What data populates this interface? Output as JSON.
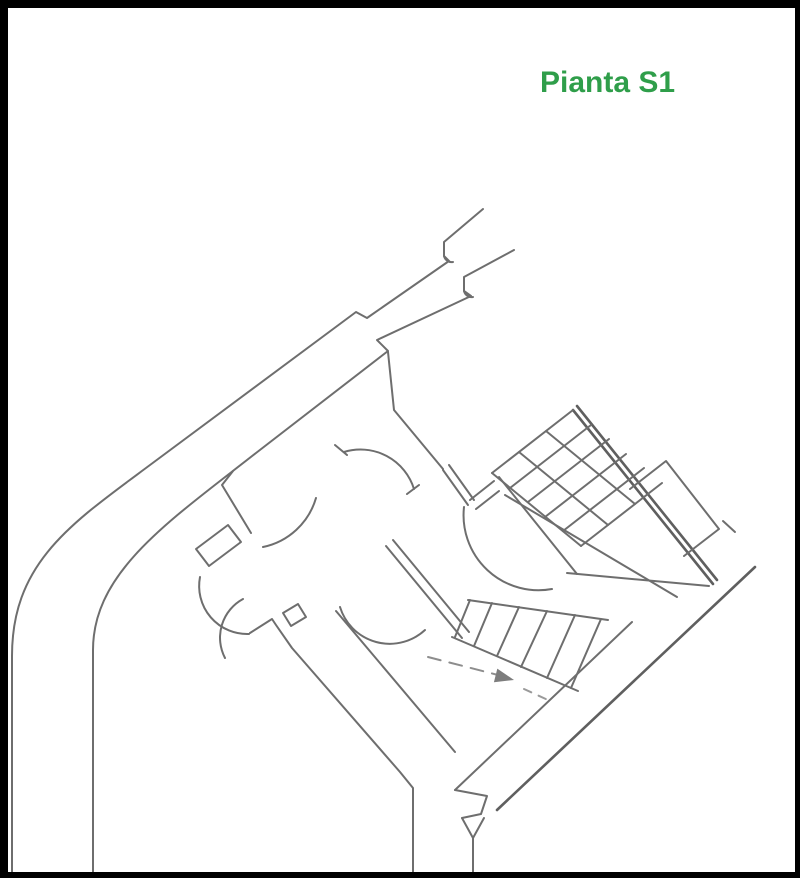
{
  "page": {
    "background_color": "#ffffff",
    "frame_color": "#000000"
  },
  "title": {
    "text": "Pianta S1",
    "color": "#2f9e4a"
  },
  "plan": {
    "kind": "architectural floor plan, basement level S1, rotated ~45 degrees",
    "line_color": "#6e6e6e",
    "features": [
      "entrance-stub-top",
      "long-curved-corridor-west",
      "central-hall",
      "door-swing-arcs",
      "double-swing-door-southwest",
      "staircase-upper-flight-grid",
      "staircase-lower-flight",
      "stair-direction-arrow",
      "shaft-stub-east",
      "exit-corridor-bottom"
    ]
  }
}
